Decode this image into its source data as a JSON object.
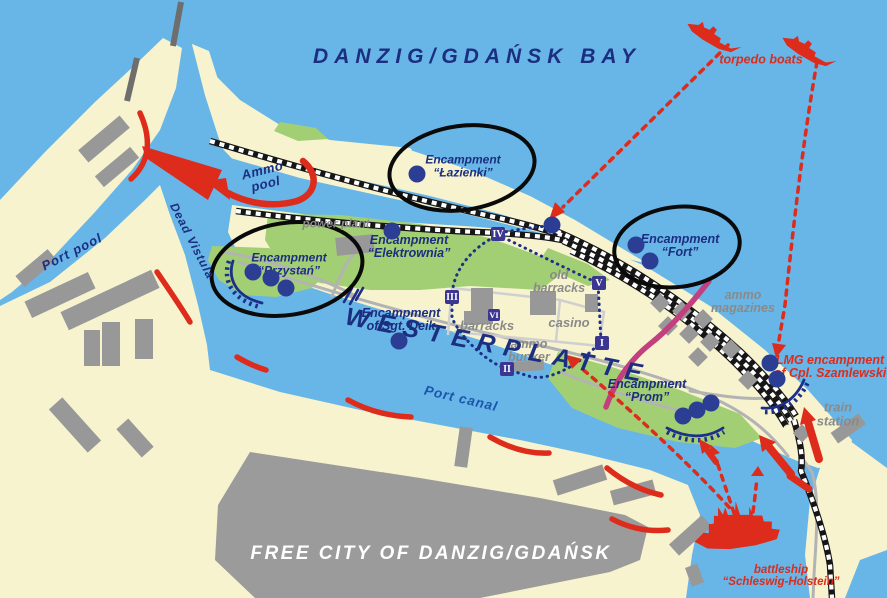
{
  "map": {
    "title": "DANZIG/GDAŃSK BAY",
    "colors": {
      "water": "#68b6e7",
      "land": "#f7f3cf",
      "green": "#a3cf74",
      "building": "#989898",
      "navy": "#1c2e80",
      "red": "#dd2b1c",
      "gray_label": "#8a8a8a",
      "white": "#ffffff",
      "canal_blue": "#1d55ad",
      "magenta": "#c2407e",
      "badge": "#3b3692",
      "dot": "#2b3e94"
    },
    "labels": [
      {
        "id": "bay-title",
        "lines": [
          "DANZIG/GDAŃSK BAY"
        ],
        "x": 477,
        "y": 57,
        "rot": 0,
        "size": 21,
        "ls": 6,
        "role": "navy"
      },
      {
        "id": "torpedo-boats",
        "lines": [
          "torpedo boats"
        ],
        "x": 761,
        "y": 60,
        "rot": 0,
        "size": 12.5,
        "ls": 0,
        "role": "red"
      },
      {
        "id": "ammo-pool",
        "lines": [
          "Ammo",
          "pool"
        ],
        "x": 264,
        "y": 177,
        "rot": -14,
        "size": 13,
        "ls": 0.5,
        "role": "navy"
      },
      {
        "id": "dead-vistula",
        "lines": [
          "Dead Vistula"
        ],
        "x": 192,
        "y": 241,
        "rot": 63,
        "size": 12,
        "ls": 1,
        "role": "navy"
      },
      {
        "id": "port-pool",
        "lines": [
          "Port pool"
        ],
        "x": 72,
        "y": 252,
        "rot": -27,
        "size": 13,
        "ls": 1,
        "role": "navy"
      },
      {
        "id": "encampment-lazienki",
        "lines": [
          "Encampment",
          "“Łazienki”"
        ],
        "x": 463,
        "y": 166,
        "rot": 0,
        "size": 12,
        "ls": 0,
        "role": "navy"
      },
      {
        "id": "power-plant",
        "lines": [
          "power plant"
        ],
        "x": 336,
        "y": 224,
        "rot": 0,
        "size": 12,
        "ls": 0,
        "role": "gray"
      },
      {
        "id": "encampment-elektrownia",
        "lines": [
          "Encampment",
          "“Elektrownia”"
        ],
        "x": 409,
        "y": 247,
        "rot": 0,
        "size": 12.5,
        "ls": 0,
        "role": "navy"
      },
      {
        "id": "encampment-przystan",
        "lines": [
          "Encampment",
          "“Przystań”"
        ],
        "x": 289,
        "y": 264,
        "rot": 0,
        "size": 12,
        "ls": 0,
        "role": "navy"
      },
      {
        "id": "encampment-fort",
        "lines": [
          "Encampment",
          "“Fort”"
        ],
        "x": 680,
        "y": 246,
        "rot": 0,
        "size": 12.5,
        "ls": 0,
        "role": "navy"
      },
      {
        "id": "old-barracks",
        "lines": [
          "old",
          "barracks"
        ],
        "x": 559,
        "y": 282,
        "rot": 0,
        "size": 12.5,
        "ls": 0,
        "role": "gray"
      },
      {
        "id": "casino",
        "lines": [
          "casino"
        ],
        "x": 569,
        "y": 323,
        "rot": 0,
        "size": 13,
        "ls": 0,
        "role": "gray"
      },
      {
        "id": "barracks",
        "lines": [
          "barracks"
        ],
        "x": 487,
        "y": 326,
        "rot": 0,
        "size": 13,
        "ls": 0,
        "role": "gray"
      },
      {
        "id": "ammo-bunker",
        "lines": [
          "ammo",
          "bunker"
        ],
        "x": 529,
        "y": 351,
        "rot": 0,
        "size": 12.5,
        "ls": 0,
        "role": "gray"
      },
      {
        "id": "encampment-sgt-deik",
        "lines": [
          "Encampment",
          "of Sgt. Deik"
        ],
        "x": 401,
        "y": 320,
        "rot": 0,
        "size": 12.5,
        "ls": 0,
        "role": "navy"
      },
      {
        "id": "westerplatte",
        "lines": [
          "WESTERPLATTE"
        ],
        "x": 498,
        "y": 346,
        "rot": 11,
        "size": 25,
        "ls": 9,
        "role": "navy"
      },
      {
        "id": "port-canal",
        "lines": [
          "Port canal"
        ],
        "x": 461,
        "y": 399,
        "rot": 13,
        "size": 13.5,
        "ls": 1,
        "role": "canal"
      },
      {
        "id": "ammo-magazines",
        "lines": [
          "ammo",
          "magazines"
        ],
        "x": 743,
        "y": 302,
        "rot": 0,
        "size": 12.5,
        "ls": 0,
        "role": "gray"
      },
      {
        "id": "lmg-encampment",
        "lines": [
          "LMG encampment",
          "of Cpl. Szamlewski"
        ],
        "x": 830,
        "y": 367,
        "rot": 0,
        "size": 12.5,
        "ls": 0,
        "role": "red"
      },
      {
        "id": "train-station",
        "lines": [
          "train",
          "station"
        ],
        "x": 838,
        "y": 414,
        "rot": 0,
        "size": 13,
        "ls": 0,
        "role": "gray"
      },
      {
        "id": "encampment-prom",
        "lines": [
          "Encampment",
          "“Prom”"
        ],
        "x": 647,
        "y": 391,
        "rot": 0,
        "size": 12.5,
        "ls": 0,
        "role": "navy"
      },
      {
        "id": "free-city",
        "lines": [
          "FREE CITY OF DANZIG/GDAŃSK"
        ],
        "x": 431,
        "y": 554,
        "rot": 0,
        "size": 19,
        "ls": 2.5,
        "role": "white"
      },
      {
        "id": "battleship-schleswig-holstein",
        "lines": [
          "battleship",
          "“Schleswig-Holstein”"
        ],
        "x": 781,
        "y": 576,
        "rot": 0,
        "size": 11.5,
        "ls": 0,
        "role": "red"
      }
    ],
    "guard_posts": [
      {
        "numeral": "I",
        "x": 602,
        "y": 343
      },
      {
        "numeral": "II",
        "x": 507,
        "y": 369
      },
      {
        "numeral": "III",
        "x": 452,
        "y": 297
      },
      {
        "numeral": "IV",
        "x": 498,
        "y": 234
      },
      {
        "numeral": "V",
        "x": 599,
        "y": 283
      },
      {
        "numeral": "VI",
        "x": 494,
        "y": 315,
        "small": true
      }
    ],
    "encampment_dots": [
      {
        "group": "lazienki",
        "x": 417,
        "y": 174
      },
      {
        "group": "elektrownia",
        "x": 392,
        "y": 231
      },
      {
        "group": "shore-rail",
        "x": 552,
        "y": 225
      },
      {
        "group": "fort",
        "x": 636,
        "y": 245
      },
      {
        "group": "fort",
        "x": 650,
        "y": 261
      },
      {
        "group": "przystan",
        "x": 253,
        "y": 272
      },
      {
        "group": "przystan",
        "x": 271,
        "y": 278
      },
      {
        "group": "przystan",
        "x": 286,
        "y": 288
      },
      {
        "group": "sgt-deik",
        "x": 399,
        "y": 341
      },
      {
        "group": "prom",
        "x": 683,
        "y": 416
      },
      {
        "group": "prom",
        "x": 697,
        "y": 410
      },
      {
        "group": "prom",
        "x": 711,
        "y": 403
      },
      {
        "group": "lmg",
        "x": 770,
        "y": 363
      },
      {
        "group": "lmg",
        "x": 777,
        "y": 379
      }
    ],
    "circled_encampments": [
      {
        "id": "lazienki",
        "cx": 462,
        "cy": 168,
        "rx": 73,
        "ry": 42,
        "rot": -8
      },
      {
        "id": "przystan",
        "cx": 287,
        "cy": 269,
        "rx": 76,
        "ry": 46,
        "rot": -9
      },
      {
        "id": "fort",
        "cx": 677,
        "cy": 247,
        "rx": 63,
        "ry": 40,
        "rot": -7
      }
    ]
  }
}
